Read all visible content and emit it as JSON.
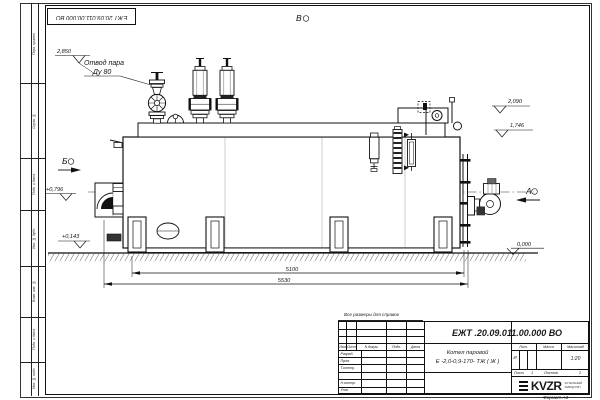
{
  "frame": {
    "doc_number_mirrored": "ЕЖТ 20.09.011.00.000  ВО",
    "stamp_labels": [
      "Перв. примен.",
      "Справ. №",
      "Подп. и дата",
      "Инв. № дубл.",
      "Взам. инв. №",
      "Подп. и дата",
      "Инв. № подл."
    ],
    "format_label": "Формат А3"
  },
  "drawing": {
    "view_top_label": "В",
    "view_left_label": "Б",
    "view_right_label": "А",
    "steam_outlet_line1": "Отвод пара",
    "steam_outlet_line2": "Ду 80",
    "elevations": {
      "top": "2,850",
      "right_upper": "2,090",
      "right_lower": "1,746",
      "left_upper": "+0,796",
      "left_lower": "+0,143",
      "ground": "0,000"
    },
    "dimensions": {
      "inner": "5100",
      "outer": "5530"
    }
  },
  "title_block": {
    "note": "Все размеры для справок",
    "doc_number": "ЕЖТ .20.09.011.00.000  ВО",
    "product_name_line1": "Котел паровой",
    "product_name_line2": "Е -2,0-0,9-170- ТЖ ( Ж )",
    "columns": {
      "izm": "Изм.",
      "list": "Лист",
      "n_dokum": "N докум.",
      "podp": "Подп.",
      "data": "Дата"
    },
    "rows": {
      "razrab": "Разраб.",
      "prov": "Пров.",
      "t_kontr": "Т.контр.",
      "n_kontr": "Н.контр.",
      "utv": "Утв."
    },
    "lit_header": "Лит.",
    "massa_header": "Масса",
    "masshtab_header": "Масштаб",
    "lit_value": "И",
    "scale_value": "1:20",
    "sheet_label": "Лист",
    "sheet_value": "1",
    "sheets_label": "Листов",
    "sheets_value": "2",
    "logo_text": "KVZR",
    "logo_sub1": "КОТЕЛЬНЫЙ",
    "logo_sub2": "ЗАВОД РЭП"
  }
}
